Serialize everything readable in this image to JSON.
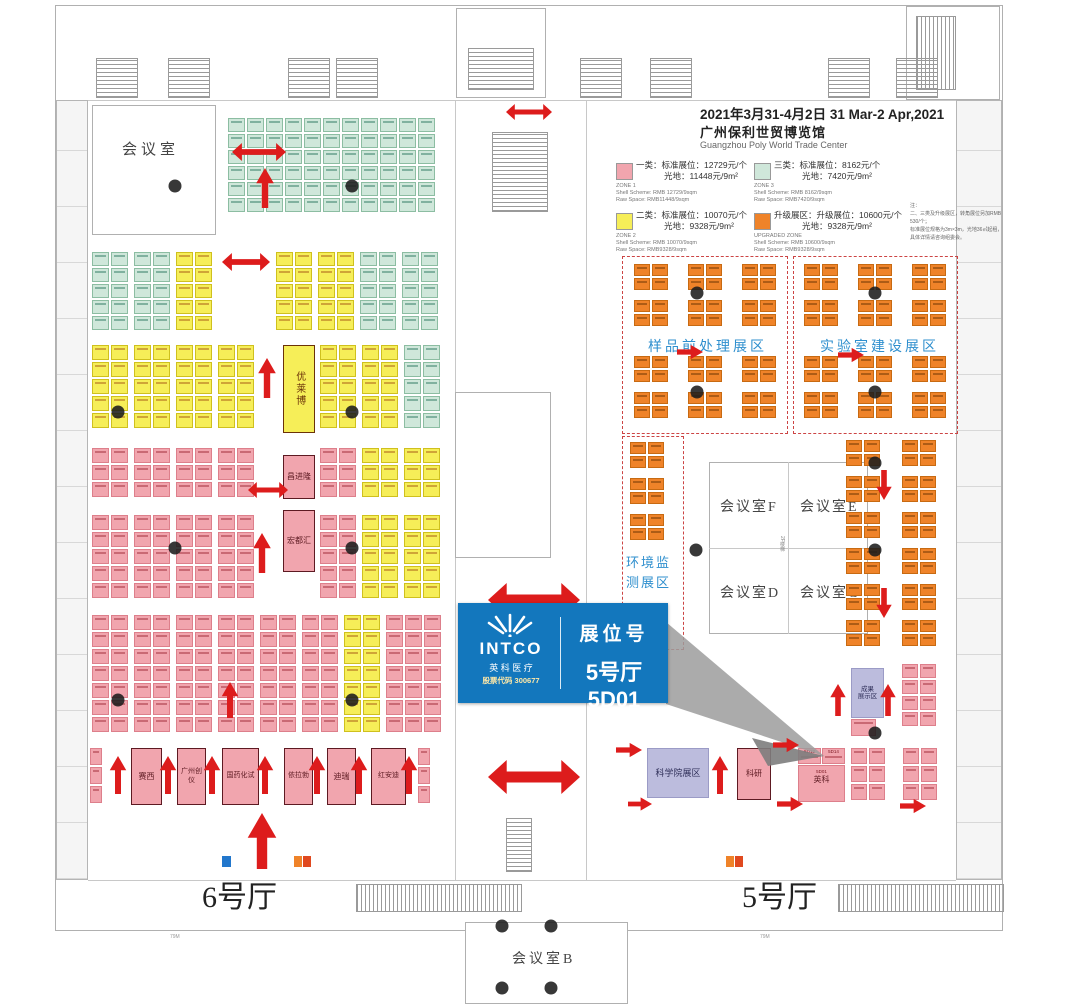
{
  "header": {
    "date": "2021年3月31-4月2日  31 Mar-2 Apr,2021",
    "venue_cn": "广州保利世贸博览馆",
    "venue_en": "Guangzhou Poly World Trade Center"
  },
  "legend": {
    "zone1": {
      "cn1": "一类：标准展位：12729元/个",
      "cn2": "光地：11448元/9m²",
      "en1": "ZONE 1",
      "en2": "Shell Scheme: RMB 12729/9sqm",
      "en3": "Raw Space: RMB11448/9sqm",
      "color": "#f1a5ae"
    },
    "zone2": {
      "cn1": "二类：标准展位：10070元/个",
      "cn2": "光地：9328元/9m²",
      "en1": "ZONE 2",
      "en2": "Shell Scheme: RMB 10070/9sqm",
      "en3": "Raw Space: RMB9328/9sqm",
      "color": "#f6ee58"
    },
    "zone3": {
      "cn1": "三类：标准展位：8162元/个",
      "cn2": "光地：7420元/9m²",
      "en1": "ZONE 3",
      "en2": "Shell Scheme: RMB 8162/9sqm",
      "en3": "Raw Space: RMB7420/9sqm",
      "color": "#cfe7da"
    },
    "upgraded": {
      "cn1": "升级展区：升级展位：10600元/个",
      "cn2": "光地：9328元/9m²",
      "en1": "UPGRADED ZONE",
      "en2": "Shell Scheme: RMB 10600/9sqm",
      "en3": "Raw Space: RMB9328/9sqm",
      "color": "#ef8329"
    },
    "note": "注：\n二、三类及升级展区，转角展位另加RMB 530/个；\n标准展位规格为3m×3m，光地36㎡起租，\n具体详情请咨询组委会。"
  },
  "callout": {
    "brand": "INTCO",
    "brand_cn": "英 科 医 疗",
    "stock": "股票代码 300677",
    "label": "展位号",
    "booth": "5号厅5D01"
  },
  "halls": {
    "hall6": "6号厅",
    "hall5": "5号厅"
  },
  "rooms": {
    "meeting": "会议室",
    "f": "会议室F",
    "e": "会议室E",
    "d": "会议室D",
    "c": "会议室C",
    "b": "会议室B",
    "stairs": "2F楼梯"
  },
  "zones": {
    "sample": "样品前处理展区",
    "lab": "实验室建设展区",
    "env1": "环境监",
    "env2": "测展区",
    "academy": "科学院展区",
    "achv1": "成果",
    "achv2": "展示区",
    "research": "科研"
  },
  "booths": {
    "youlaibo": "优莱博",
    "changjinlong": "昌进隆",
    "hongduhui": "宏都汇",
    "intco_name": "英科",
    "intco_code": "5D01",
    "intco_codes": [
      "5D13",
      "5D14"
    ],
    "bottom_row": [
      "赛西",
      "广州创仪",
      "国药化试",
      "依拉勃",
      "迪瑞",
      "红安迪"
    ]
  },
  "dims": {
    "left": "79M",
    "right": "79M"
  },
  "colors": {
    "callout_blue": "#1377bd",
    "arrow_red": "#dd1c1c",
    "zone_label_blue": "#2f8fce",
    "beam_grey": "#9c9c9c"
  }
}
